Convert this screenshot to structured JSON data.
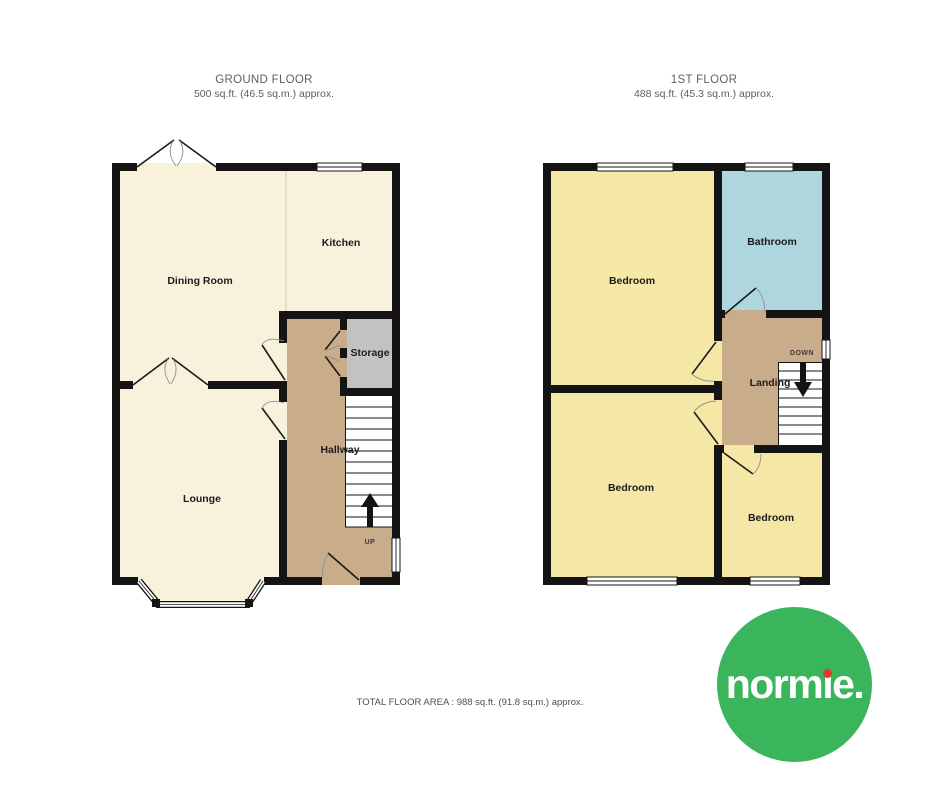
{
  "ground_floor": {
    "title": "GROUND FLOOR",
    "subtitle": "500 sq.ft. (46.5 sq.m.) approx.",
    "rooms": {
      "dining_room": "Dining Room",
      "kitchen": "Kitchen",
      "storage": "Storage",
      "hallway": "Hallway",
      "lounge": "Lounge"
    },
    "stair_direction": "UP"
  },
  "first_floor": {
    "title": "1ST FLOOR",
    "subtitle": "488 sq.ft. (45.3 sq.m.) approx.",
    "rooms": {
      "bedroom_front": "Bedroom",
      "bathroom": "Bathroom",
      "landing": "Landing",
      "bedroom_rear": "Bedroom",
      "bedroom_small": "Bedroom"
    },
    "stair_direction": "DOWN"
  },
  "footer": {
    "total_area_label": "TOTAL FLOOR AREA : 988 sq.ft. (91.8 sq.m.) approx."
  },
  "logo": {
    "brand": "normie.",
    "name_start": "norm",
    "name_i_stem": "ı",
    "name_end": "e.",
    "circle_color": "#3ab55c",
    "i_dot_color": "#e2382f",
    "text_color": "#ffffff"
  },
  "colors": {
    "wall": "#141414",
    "cream_room": "#f8f2dd",
    "yellow_room": "#f5e7a6",
    "blue_room": "#aed6de",
    "tan_hall": "#c9ad8a",
    "gray_storage": "#c2c2c2",
    "stairs": "#ffffff",
    "title_text": "#5f5f5f",
    "label_text": "#1c1c1c"
  }
}
